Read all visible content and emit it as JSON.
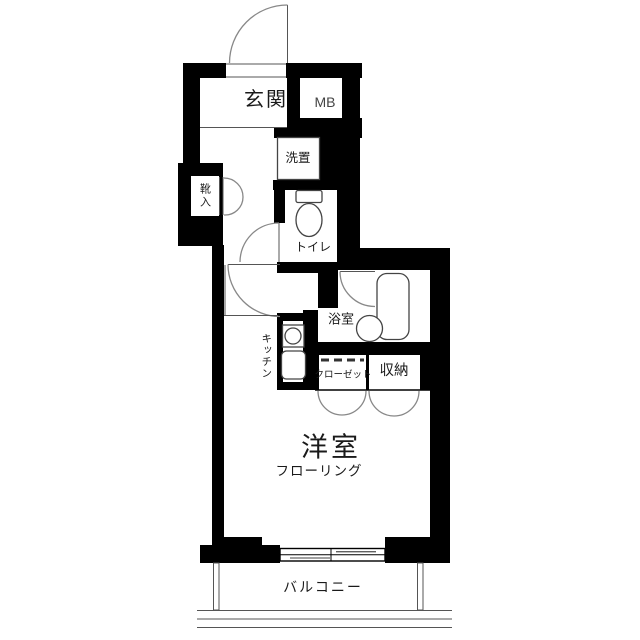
{
  "plan_type": "apartment-floor-plan",
  "colors": {
    "wall": "#000000",
    "floor": "#ffffff",
    "arc": "#888888",
    "line": "#444444",
    "text": "#1a1a1a"
  },
  "rooms": {
    "genkan": {
      "label": "玄関"
    },
    "meter_box": {
      "label": "MB"
    },
    "washer": {
      "label": "洗置"
    },
    "shoe_cabinet": {
      "label": "靴入"
    },
    "toilet": {
      "label": "トイレ"
    },
    "bathroom": {
      "label": "浴室"
    },
    "kitchen": {
      "label": "キッチン"
    },
    "closet": {
      "label": "クローゼット"
    },
    "storage": {
      "label": "収納"
    },
    "western_room": {
      "label": "洋室",
      "floor_label": "フローリング"
    },
    "balcony": {
      "label": "バルコニー"
    }
  }
}
